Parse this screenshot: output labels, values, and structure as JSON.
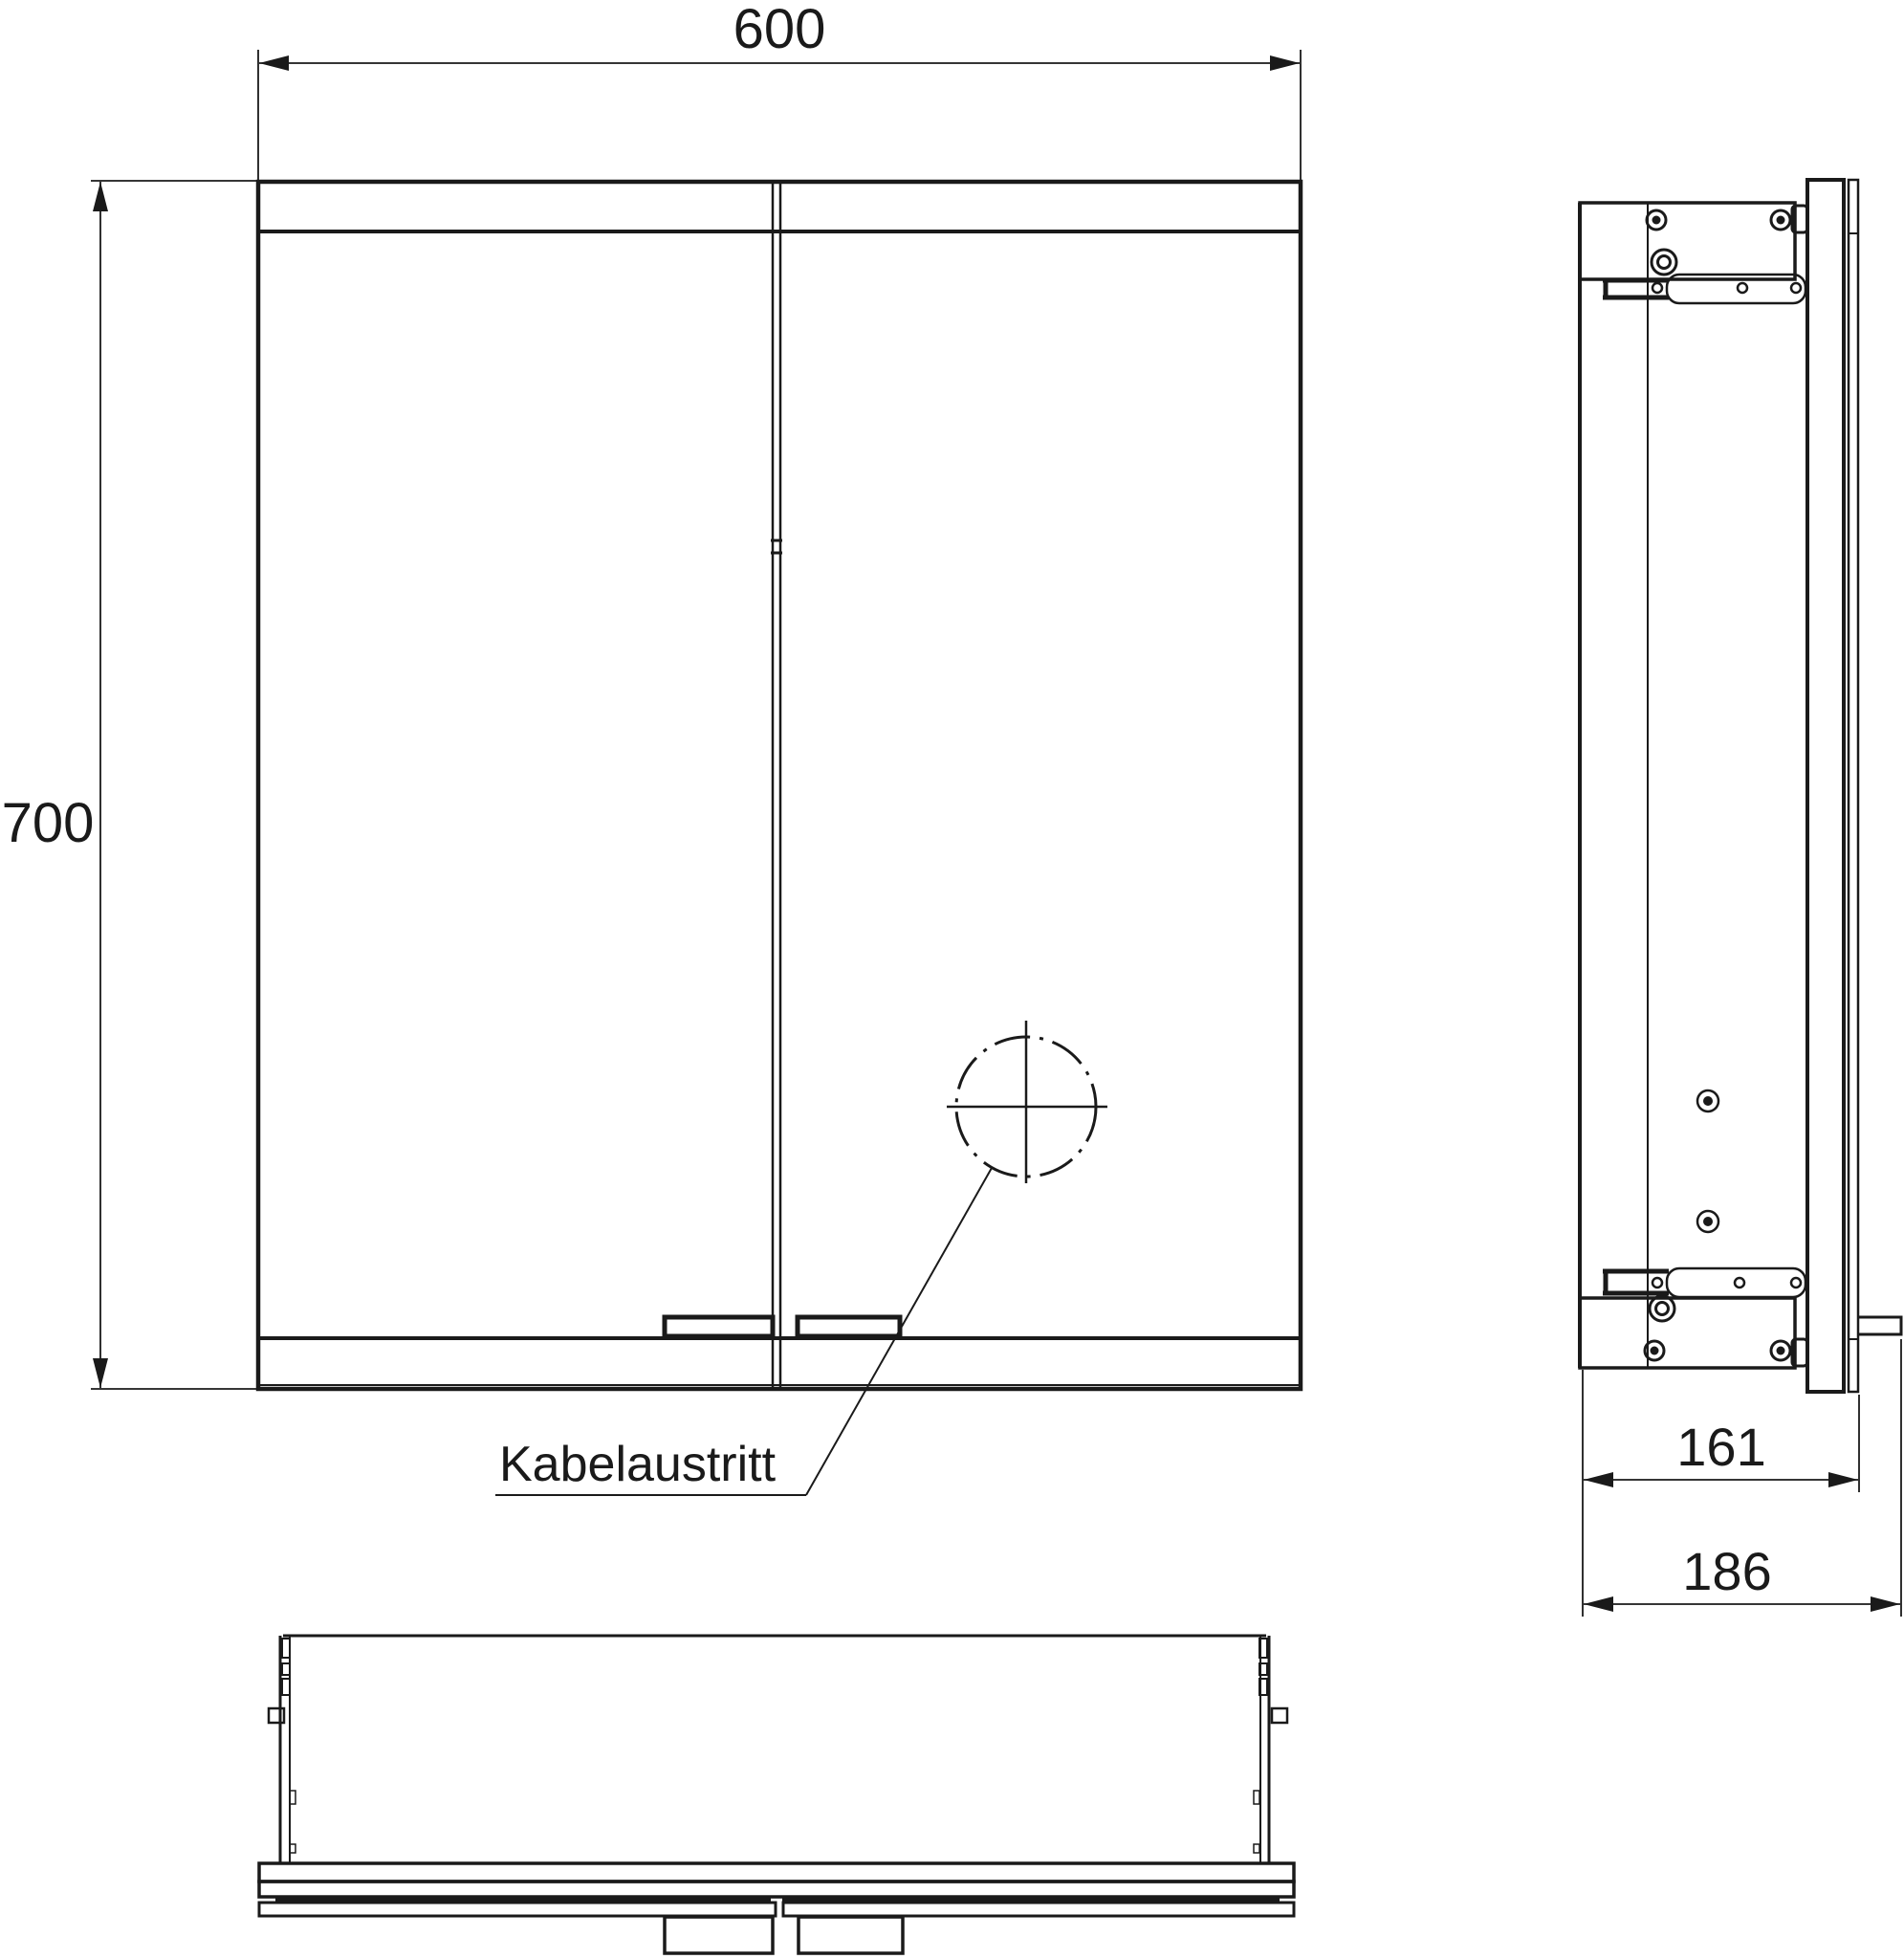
{
  "drawing": {
    "type": "technical-drawing-mirror-cabinet",
    "views": [
      "front",
      "side",
      "bottom"
    ],
    "labels": {
      "cable_outlet": "Kabelaustritt"
    },
    "dimensions": {
      "front_width": "600",
      "front_height": "700",
      "side_depth_body": "161",
      "side_depth_total": "186"
    },
    "colors": {
      "line": "#1a1a1a",
      "background": "#ffffff"
    }
  }
}
